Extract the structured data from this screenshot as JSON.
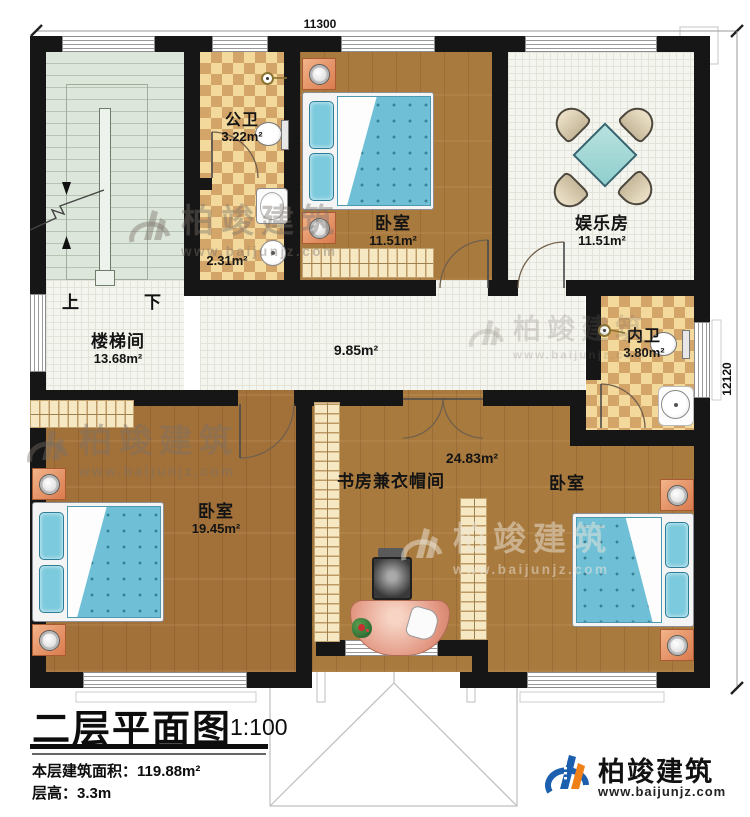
{
  "dimensions": {
    "top": "11300",
    "right": "12120"
  },
  "rooms": {
    "stairwell": {
      "name": "楼梯间",
      "area": "13.68m²",
      "up": "上",
      "down": "下"
    },
    "public_bath": {
      "name": "公卫",
      "area": "3.22m²"
    },
    "wash_area": {
      "area": "2.31m²"
    },
    "bedroom_top": {
      "name": "卧室",
      "area": "11.51m²"
    },
    "entertainment": {
      "name": "娱乐房",
      "area": "11.51m²"
    },
    "hallway": {
      "area": "9.85m²"
    },
    "ensuite_bath": {
      "name": "内卫",
      "area": "3.80m²"
    },
    "bedroom_left": {
      "name": "卧室",
      "area": "19.45m²"
    },
    "study": {
      "name": "书房兼衣帽间",
      "area": "24.83m²"
    },
    "bedroom_right": {
      "name": "卧室"
    }
  },
  "title_block": {
    "title": "二层平面图",
    "scale": "1:100",
    "area_line": "本层建筑面积：119.88m²",
    "height_line": "层高：3.3m"
  },
  "brand": {
    "name": "柏竣建筑",
    "url": "www.baijunjz.com"
  },
  "watermark": {
    "name": "柏竣建筑",
    "url": "www.baijunjz.com"
  },
  "colors": {
    "wall": "#161616",
    "wood": "#a97a3e",
    "tile": "#f5f5f0",
    "chk-l": "#f3d99c",
    "chk-d": "#d4a569",
    "stair": "#dce6da",
    "bedblue": "#6fc0d6",
    "logo-blue": "#1b5fae",
    "logo-orange": "#f08018"
  }
}
